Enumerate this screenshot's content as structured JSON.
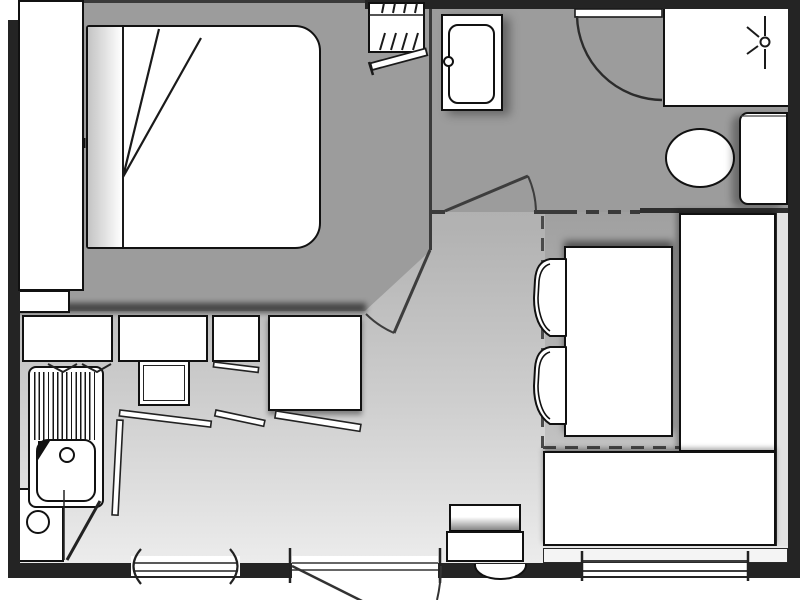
{
  "plan": {
    "kind": "mobile-home floor plan, top-down architectural drawing, no text labels",
    "palette": {
      "wall": "#242424",
      "interior_partition": "#3a3a3a",
      "bedroom_floor": "#9c9c9c",
      "hall_bath_floor": "#9c9c9c",
      "dining_floor_top": "#a0a0a0",
      "living_floor_gradient": [
        "#a6a6a6",
        "#ececec"
      ],
      "furniture_fill": "#ffffff",
      "furniture_line": "#111111"
    },
    "rooms": {
      "bedroom": {
        "position": "top-left",
        "items": [
          "headboard-cabinet",
          "double-bed-mattress",
          "folded-duvet-corner",
          "bedside-box",
          "wardrobe-with-hangers",
          "wardrobe-open-door"
        ]
      },
      "bathroom": {
        "position": "top-right",
        "items": [
          "washbasin-unit",
          "shower-tray",
          "shower-light-symbol",
          "shower-pivot-door",
          "toilet-bowl",
          "toilet-cistern"
        ]
      },
      "kitchen": {
        "position": "left-middle",
        "items": [
          "counter-unit-1",
          "counter-unit-2",
          "counter-unit-3",
          "fridge-unit",
          "hob-square",
          "sink-drainer-striped",
          "sink-bowl",
          "tap-hole",
          "lower-cabinet-with-burner-circle",
          "open-door-leaves",
          "flap-door-marks"
        ]
      },
      "dining": {
        "position": "right-middle",
        "items": [
          "dinette-table",
          "bench-seat-vertical",
          "bench-seat-horizontal",
          "chair-1",
          "chair-2",
          "dashed-conversion-outline",
          "window-ledge-strip"
        ]
      },
      "living": {
        "position": "bottom-center",
        "items": [
          "wall-heater-unit",
          "entry-step-semicircle"
        ]
      }
    },
    "openings": {
      "entry_door": "bottom wall, swings outward, leaf and arc clipped at image edge",
      "window_left": "bottom wall with parenthesis-shaped end arcs",
      "window_right": "bottom wall, double-line glazing with end ticks",
      "bathroom_door": "interior wall, hinged left, swings into bathroom",
      "bedroom_door": "angled doorway beside kitchen counter corner",
      "shower_door": "pivot door shown open against top wall with quarter-circle swing arc"
    }
  }
}
